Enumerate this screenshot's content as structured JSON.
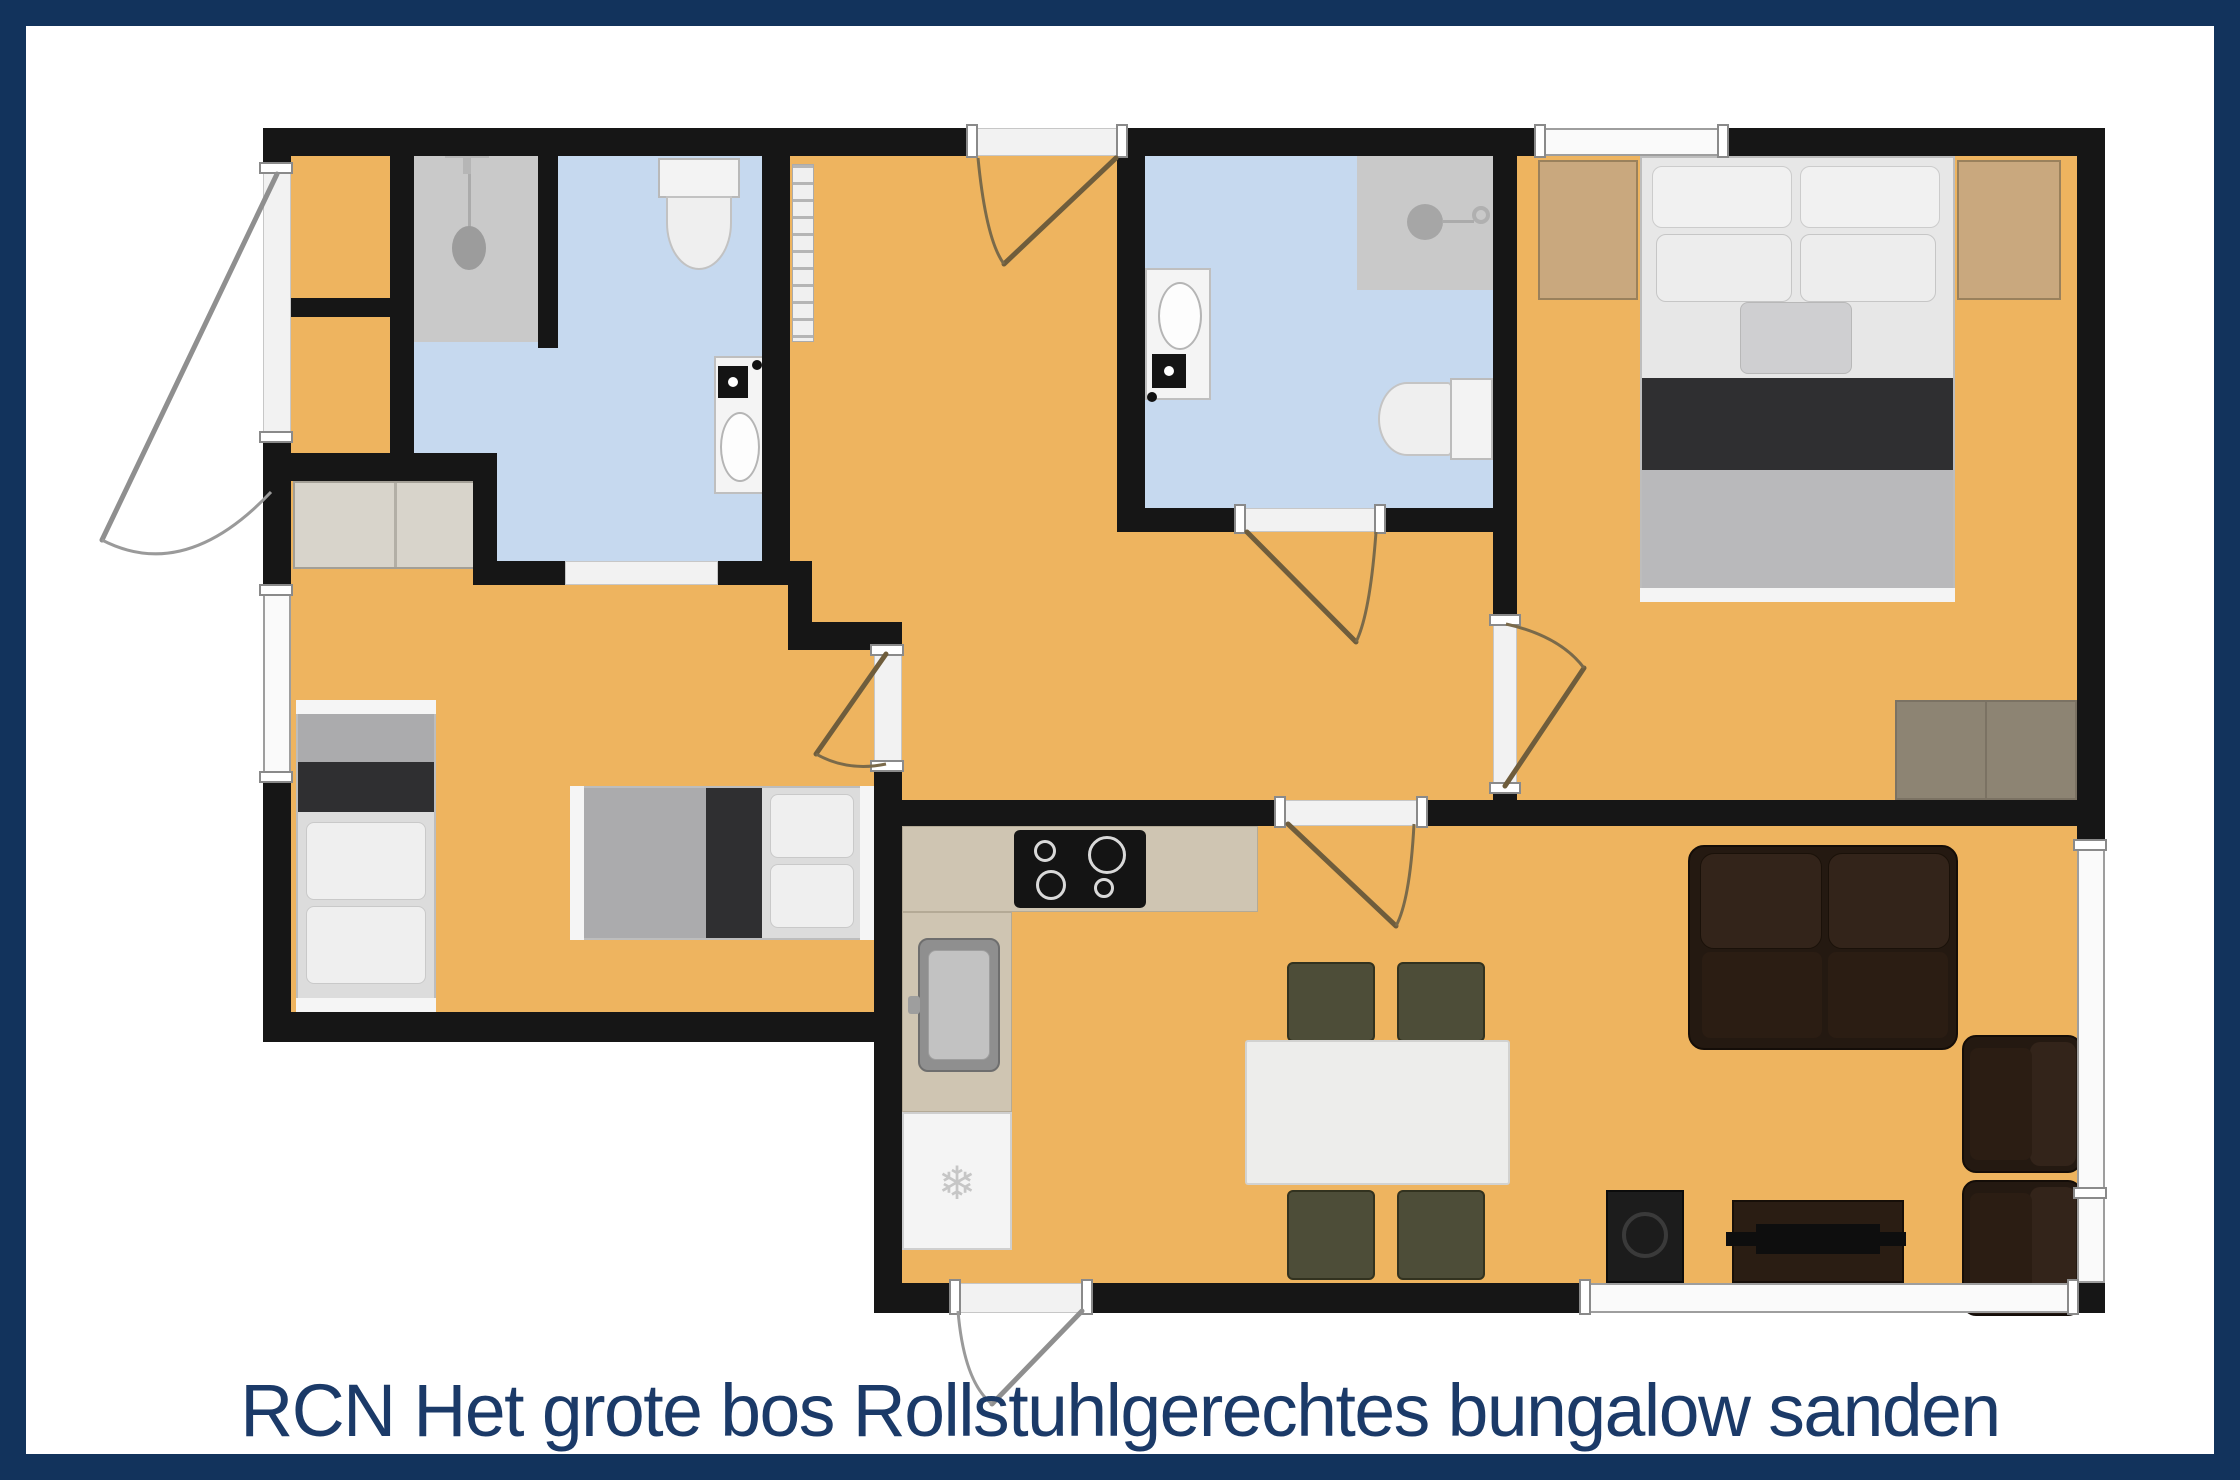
{
  "caption": {
    "text": "RCN Het grote bos Rollstuhlgerechtes bungalow sanden"
  },
  "icons": {
    "fridge_snowflake": "❄"
  },
  "palette": {
    "frame_navy": "#12335c",
    "caption_blue": "#1b3a68",
    "wall": "#161616",
    "floor_orange": "#eeb45f",
    "floor_blue": "#c6d9ef",
    "shower_gray": "#c9c9c9",
    "closet_gray": "#d8d4cb",
    "counter_beige": "#cfc5b2",
    "wood_tan": "#c9a87e",
    "rug_brown": "#8d8473",
    "sofa_espresso": "#241911",
    "chair_olive": "#4d4d38",
    "window_fill": "#fafafa"
  }
}
